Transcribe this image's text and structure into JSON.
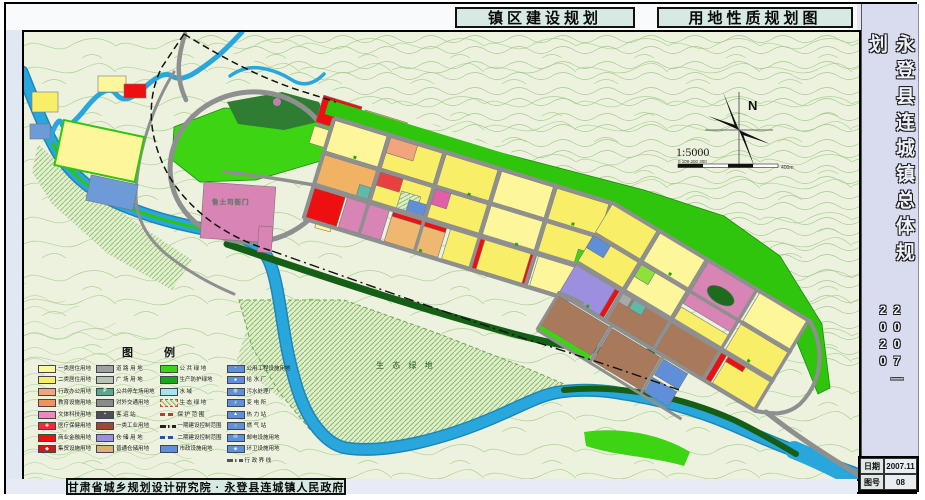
{
  "frame": {
    "titles": [
      {
        "label": "镇区建设规划"
      },
      {
        "label": "用地性质规划图"
      }
    ],
    "sidebar": {
      "title": "永登县连城镇总体规划",
      "period": "2007—2020"
    },
    "info": {
      "date_label": "日期",
      "date_value": "2007.11",
      "sheet_label": "图号",
      "sheet_value": "08"
    },
    "credit": "甘肃省城乡规划设计研究院 · 永登县连城镇人民政府"
  },
  "map": {
    "labels": {
      "heritage": "鲁土司衙门",
      "eco_green": "生 态 绿 地",
      "north": "N",
      "scale": "1:5000",
      "scale_ticks": "0    100    200    300",
      "scale_end": "400m"
    },
    "legend": {
      "title": "图  例",
      "columns": [
        [
          {
            "label": "一类居住用地",
            "type": "fill",
            "color": "#FDF69A"
          },
          {
            "label": "二类居住用地",
            "type": "fill",
            "color": "#F9EE67"
          },
          {
            "label": "行政办公用地",
            "type": "fill",
            "color": "#F2A47C"
          },
          {
            "label": "教育设施用地",
            "type": "fill",
            "color": "#F0935F"
          },
          {
            "label": "文体科技用地",
            "type": "fill",
            "color": "#EF86C0"
          },
          {
            "label": "医疗保健用地",
            "type": "fill",
            "color": "#E83030",
            "icon": "✚"
          },
          {
            "label": "商业金融用地",
            "type": "fill",
            "color": "#EE1010"
          },
          {
            "label": "集贸设施用地",
            "type": "fill",
            "color": "#D01818",
            "icon": "◆"
          }
        ],
        [
          {
            "label": "道 路 用 地",
            "type": "fill",
            "color": "#A0A0A0"
          },
          {
            "label": "广 场 用 地",
            "type": "fill",
            "color": "#B8C4B0"
          },
          {
            "label": "公共停车场用地",
            "type": "fill",
            "color": "#58A890",
            "icon": "P"
          },
          {
            "label": "对外交通用地",
            "type": "fill",
            "color": "#8A8A8A"
          },
          {
            "label": "客  运  站",
            "type": "fill",
            "color": "#505050",
            "icon": "▪"
          },
          {
            "label": "一类工业用地",
            "type": "fill",
            "color": "#9A4A30"
          },
          {
            "label": "仓 储 用 地",
            "type": "fill",
            "color": "#9D8FE0"
          },
          {
            "label": "普通仓储用地",
            "type": "fill",
            "color": "#D9B175"
          }
        ],
        [
          {
            "label": "公 共 绿 地",
            "type": "fill",
            "color": "#3DD413"
          },
          {
            "label": "生产防护绿地",
            "type": "fill",
            "color": "#17A817"
          },
          {
            "label": "水        域",
            "type": "fill",
            "color": "#A8E4F0"
          },
          {
            "label": "生 态 绿 地",
            "type": "hatch",
            "color": "#86BB6D"
          },
          {
            "label": "保 护 范 围",
            "type": "line-dash",
            "color": "#D03030"
          },
          {
            "label": "一期建设控制范围",
            "type": "line-dashdot",
            "color": "#222222"
          },
          {
            "label": "二期建设控制范围",
            "type": "line-dash",
            "color": "#2255AA"
          },
          {
            "label": "市政设施用地",
            "type": "fill",
            "color": "#5F8FD8"
          }
        ],
        [
          {
            "label": "公用工程设施用地",
            "type": "fill",
            "color": "#5F8FD8",
            "icon": "▫"
          },
          {
            "label": "给 水 厂",
            "type": "fill",
            "color": "#5F8FD8",
            "icon": "●"
          },
          {
            "label": "污水处理厂",
            "type": "fill",
            "color": "#5F8FD8",
            "icon": "◍"
          },
          {
            "label": "变 电 所",
            "type": "fill",
            "color": "#5F8FD8",
            "icon": "⚡"
          },
          {
            "label": "热 力 站",
            "type": "fill",
            "color": "#5F8FD8",
            "icon": "▲"
          },
          {
            "label": "燃 气 站",
            "type": "fill",
            "color": "#5F8FD8",
            "icon": "○"
          },
          {
            "label": "邮电设施用地",
            "type": "fill",
            "color": "#5F8FD8",
            "icon": "✉"
          },
          {
            "label": "环卫设施用地",
            "type": "fill",
            "color": "#5F8FD8",
            "icon": "◈"
          },
          {
            "label": "行 政 界 线",
            "type": "line-dashdot",
            "color": "#555555"
          }
        ]
      ]
    },
    "palette": {
      "map_background": "#ECF2DE",
      "contour_line": "#AED194",
      "river": "#29A7DD",
      "road": "#8F8F8F",
      "residential_light": "#FDF69A",
      "residential": "#F9EE67",
      "commercial_red": "#EE1010",
      "heritage_pink": "#D884B4",
      "education_orange": "#F2B263",
      "industry_brown": "#A8795A",
      "storage_purple": "#9D8FE0",
      "utility_blue": "#5F8FD8",
      "public_green": "#3DD413",
      "protect_green": "#17A817",
      "sidebar_bg": "#D8DCEE",
      "titlebox_bg": "#D6E9E3"
    }
  }
}
